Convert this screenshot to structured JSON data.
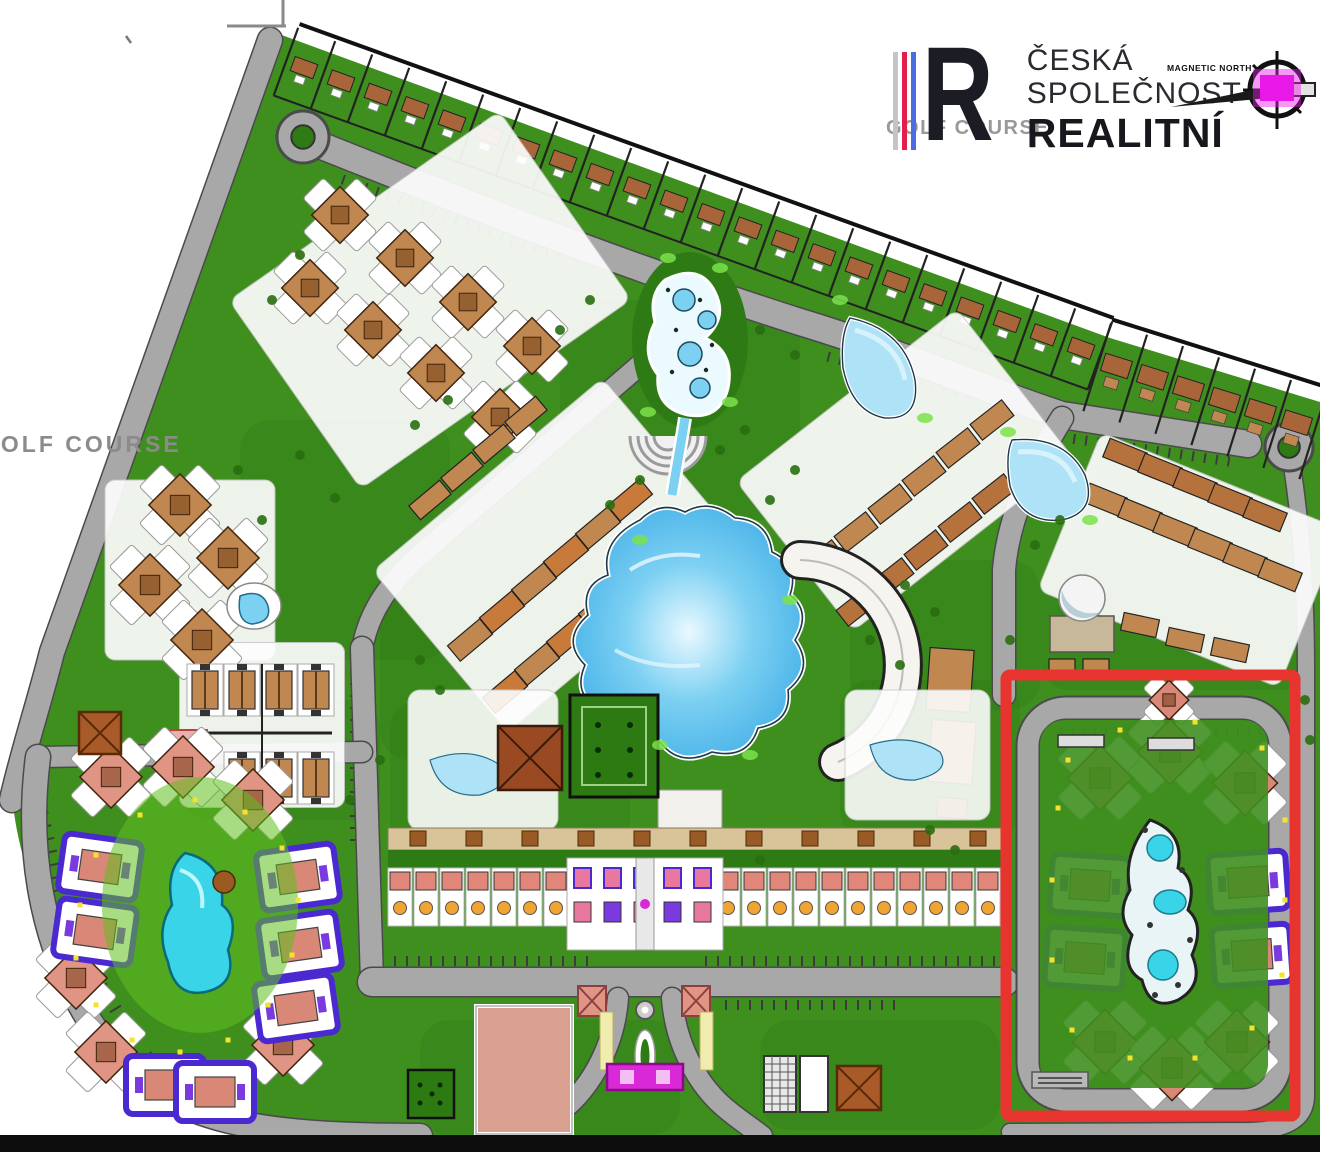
{
  "logo": {
    "letter": "R",
    "line1": "ČESKÁ",
    "line2": "SPOLEČNOST",
    "line3": "REALITNÍ",
    "stripe_colors": [
      "#c6c4c4",
      "#e0204a",
      "#4a6ee0"
    ],
    "letter_color": "#1c1c24",
    "text_color": "#2a2a30",
    "strong_color": "#17171d"
  },
  "compass": {
    "label": "MAGNETIC NORTH",
    "needle_color": "#1a1a1a",
    "center_color": "#e818e8"
  },
  "labels": {
    "golf_course_left": "GOLF COURSE",
    "golf_course_center": "GOLF COURSE",
    "label_color": "#8c8a8a"
  },
  "highlight": {
    "color": "#e8342e",
    "x": 1006,
    "y": 675,
    "width": 289,
    "height": 441,
    "stroke_width": 11
  },
  "footer": {
    "bar_color": "#0d0d0d"
  },
  "palette": {
    "lawn": "#3f8f1f",
    "lawn_dark": "#2e7a14",
    "lawn_bright": "#5fc01e",
    "lime": "#7be24a",
    "road": "#a8a8a8",
    "road_edge": "#4a4a4a",
    "outline": "#1f1f1f",
    "water_light": "#aee2f6",
    "water_mid": "#7cd0f2",
    "water_deep": "#52b8ea",
    "cyan": "#3ad4e8",
    "building_tan": "#c08850",
    "building_brown": "#a9653a",
    "roof_brown": "#9a4a22",
    "salmon": "#d98878",
    "salmon_light": "#e8a898",
    "pink": "#e878a0",
    "purple": "#4a2ad0",
    "violet": "#7a3ae0",
    "magenta": "#d828d8",
    "yellow": "#f5e32a",
    "orange": "#f0a434",
    "white": "#ffffff"
  }
}
